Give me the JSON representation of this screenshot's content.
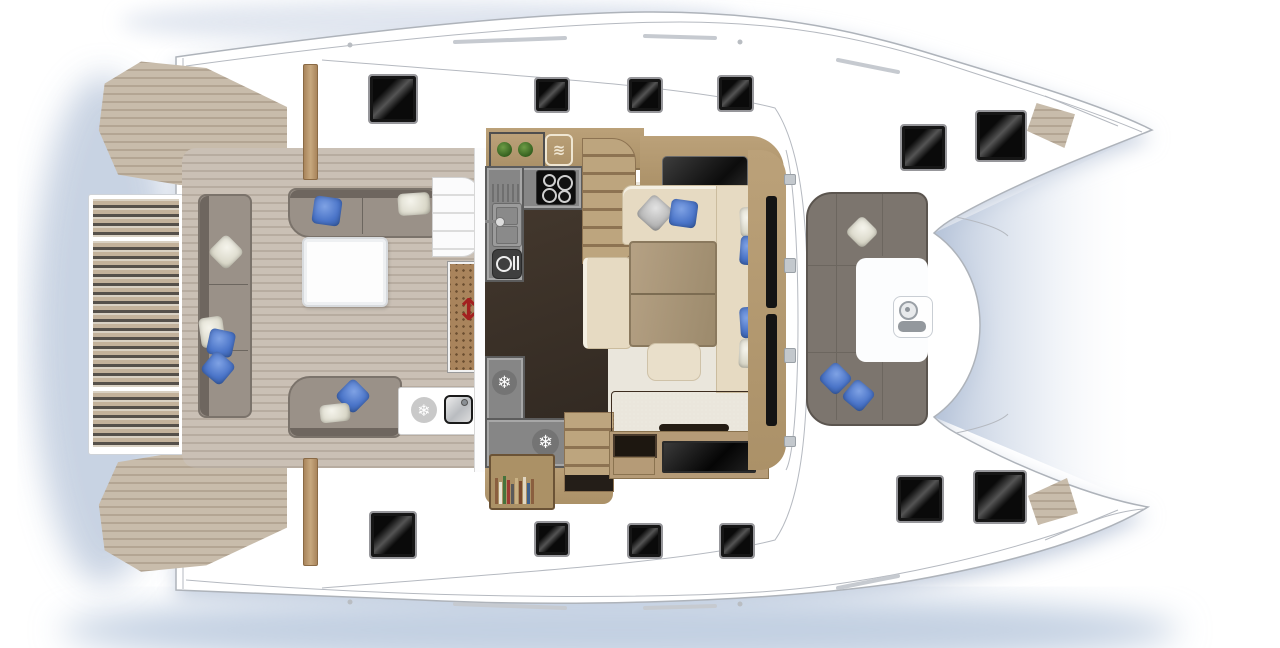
{
  "meta": {
    "description": "catamaran-deck-plan-top-view",
    "visible_text": "none"
  },
  "colors": {
    "hull_white": "#ffffff",
    "outline_gray": "#aeb3ba",
    "shadow_blue": "#bcc8dc",
    "teak": "#c0b19d",
    "cockpit_sofa_gray": "#9a9188",
    "forward_sofa_gray": "#7c756e",
    "salon_beige": "#e6dac2",
    "table_wood": "#ab9372",
    "galley_counter_gray": "#868686",
    "galley_floor_dark": "#3c3228",
    "pillow_blue": "#4a74c8",
    "pillow_white": "#e8e6d8",
    "leather_brown": "#55402f",
    "hatch_black": "#0a0a0a",
    "arrow_red": "#a32020",
    "plant_green": "#4a7a30"
  },
  "icons": {
    "snowflake_glyph": "❄",
    "oven_waves_glyph": "≋",
    "slide_arrow_glyph": "↕"
  },
  "areas": {
    "swim_platform": "hydraulic swim platform",
    "port_transom": "port transom teak steps",
    "starboard_transom": "starboard transom teak steps",
    "aft_cockpit": "aft cockpit",
    "galley": "galley",
    "salon": "salon dinette",
    "forward_cockpit": "forward cockpit",
    "foredeck": "foredeck",
    "port_bow": "port bow",
    "starboard_bow": "starboard bow"
  },
  "hatches": [
    {
      "x": 370,
      "y": 76,
      "s": 40
    },
    {
      "x": 536,
      "y": 79,
      "s": 26
    },
    {
      "x": 629,
      "y": 79,
      "s": 26
    },
    {
      "x": 719,
      "y": 77,
      "s": 27
    },
    {
      "x": 902,
      "y": 126,
      "s": 37
    },
    {
      "x": 977,
      "y": 112,
      "s": 42
    },
    {
      "x": 371,
      "y": 513,
      "s": 38
    },
    {
      "x": 536,
      "y": 523,
      "s": 26
    },
    {
      "x": 629,
      "y": 525,
      "s": 26
    },
    {
      "x": 721,
      "y": 525,
      "s": 26
    },
    {
      "x": 898,
      "y": 477,
      "s": 38
    },
    {
      "x": 975,
      "y": 472,
      "s": 44
    }
  ],
  "bookshelf": {
    "spine_colors": [
      "#8a5f3f",
      "#e8e2d4",
      "#46733c",
      "#9c3b32",
      "#5a5a5a",
      "#c9b184",
      "#7b4a2e",
      "#e0d6c2",
      "#3e5f8a",
      "#8a5f3f"
    ],
    "spine_heights": [
      26,
      22,
      28,
      24,
      20,
      26,
      23,
      27,
      21,
      25
    ]
  }
}
